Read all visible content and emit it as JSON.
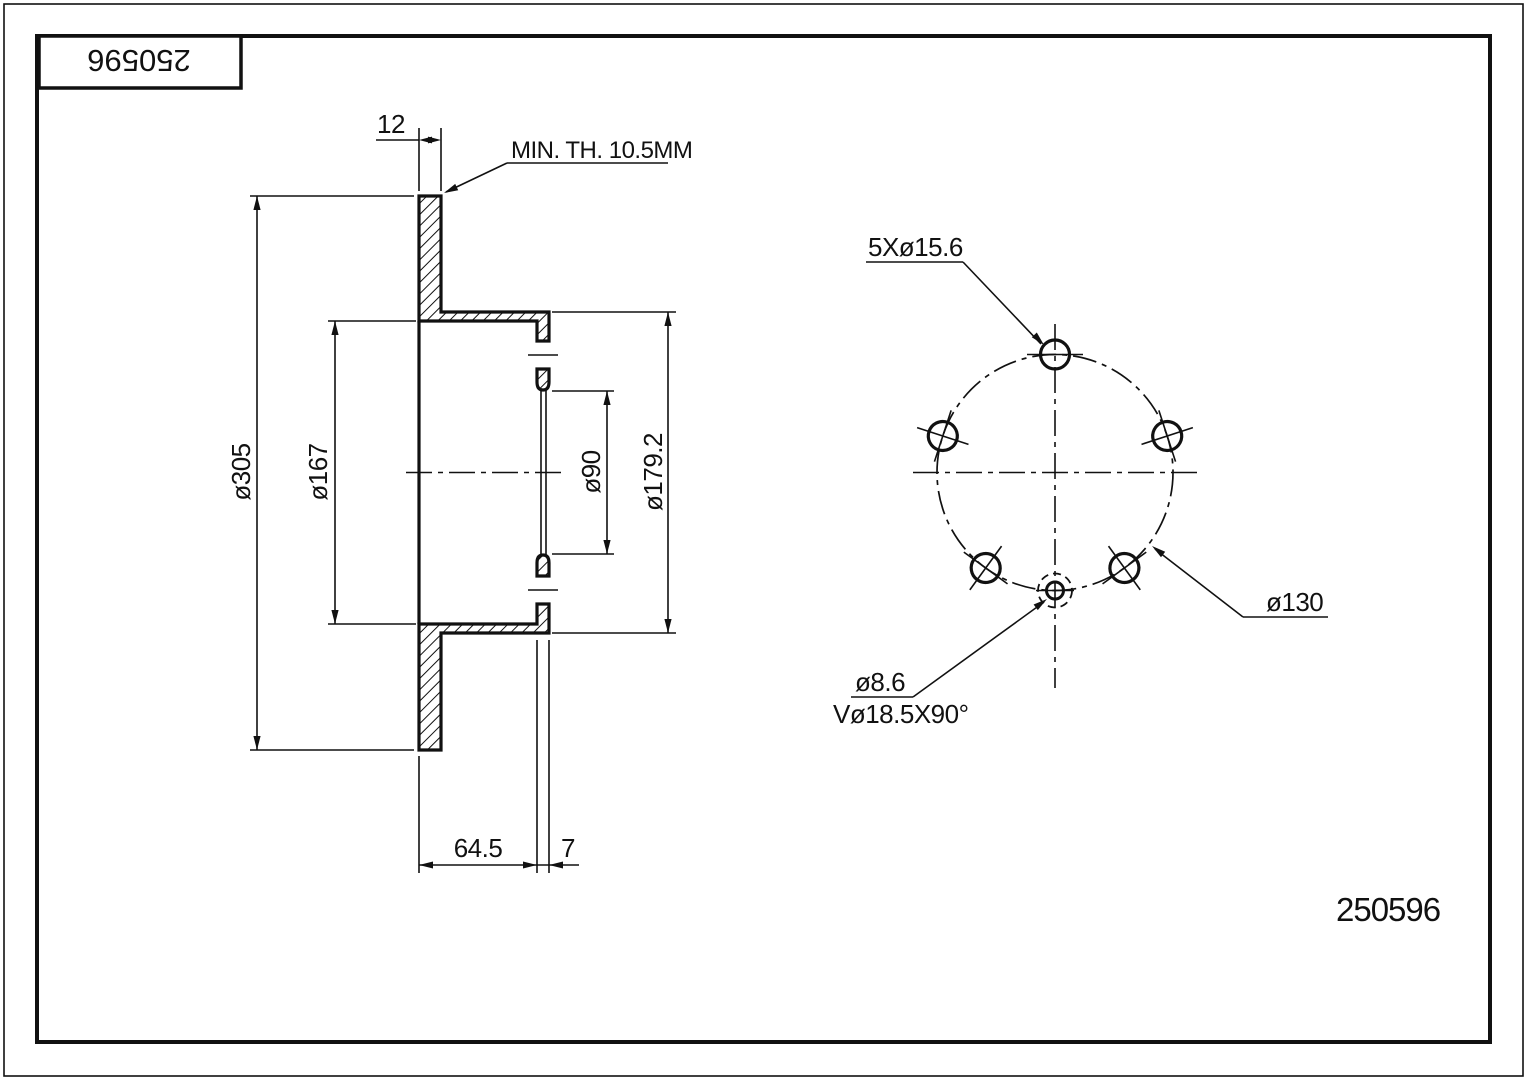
{
  "title_block": {
    "part_number": "250596"
  },
  "footer": {
    "part_number": "250596"
  },
  "section_view": {
    "disc_thickness": "12",
    "min_thickness_note": "MIN. TH. 10.5MM",
    "outer_diameter": "ø305",
    "hat_inner_diameter": "ø167",
    "center_bore_diameter": "ø90",
    "hat_outer_diameter": "ø179.2",
    "overall_height": "64.5",
    "mount_face_thickness": "7"
  },
  "front_view": {
    "bolt_hole_spec": "5Xø15.6",
    "bolt_circle_diameter": "ø130",
    "pin_hole_diameter": "ø8.6",
    "countersink_spec": "Vø18.5X90°"
  }
}
